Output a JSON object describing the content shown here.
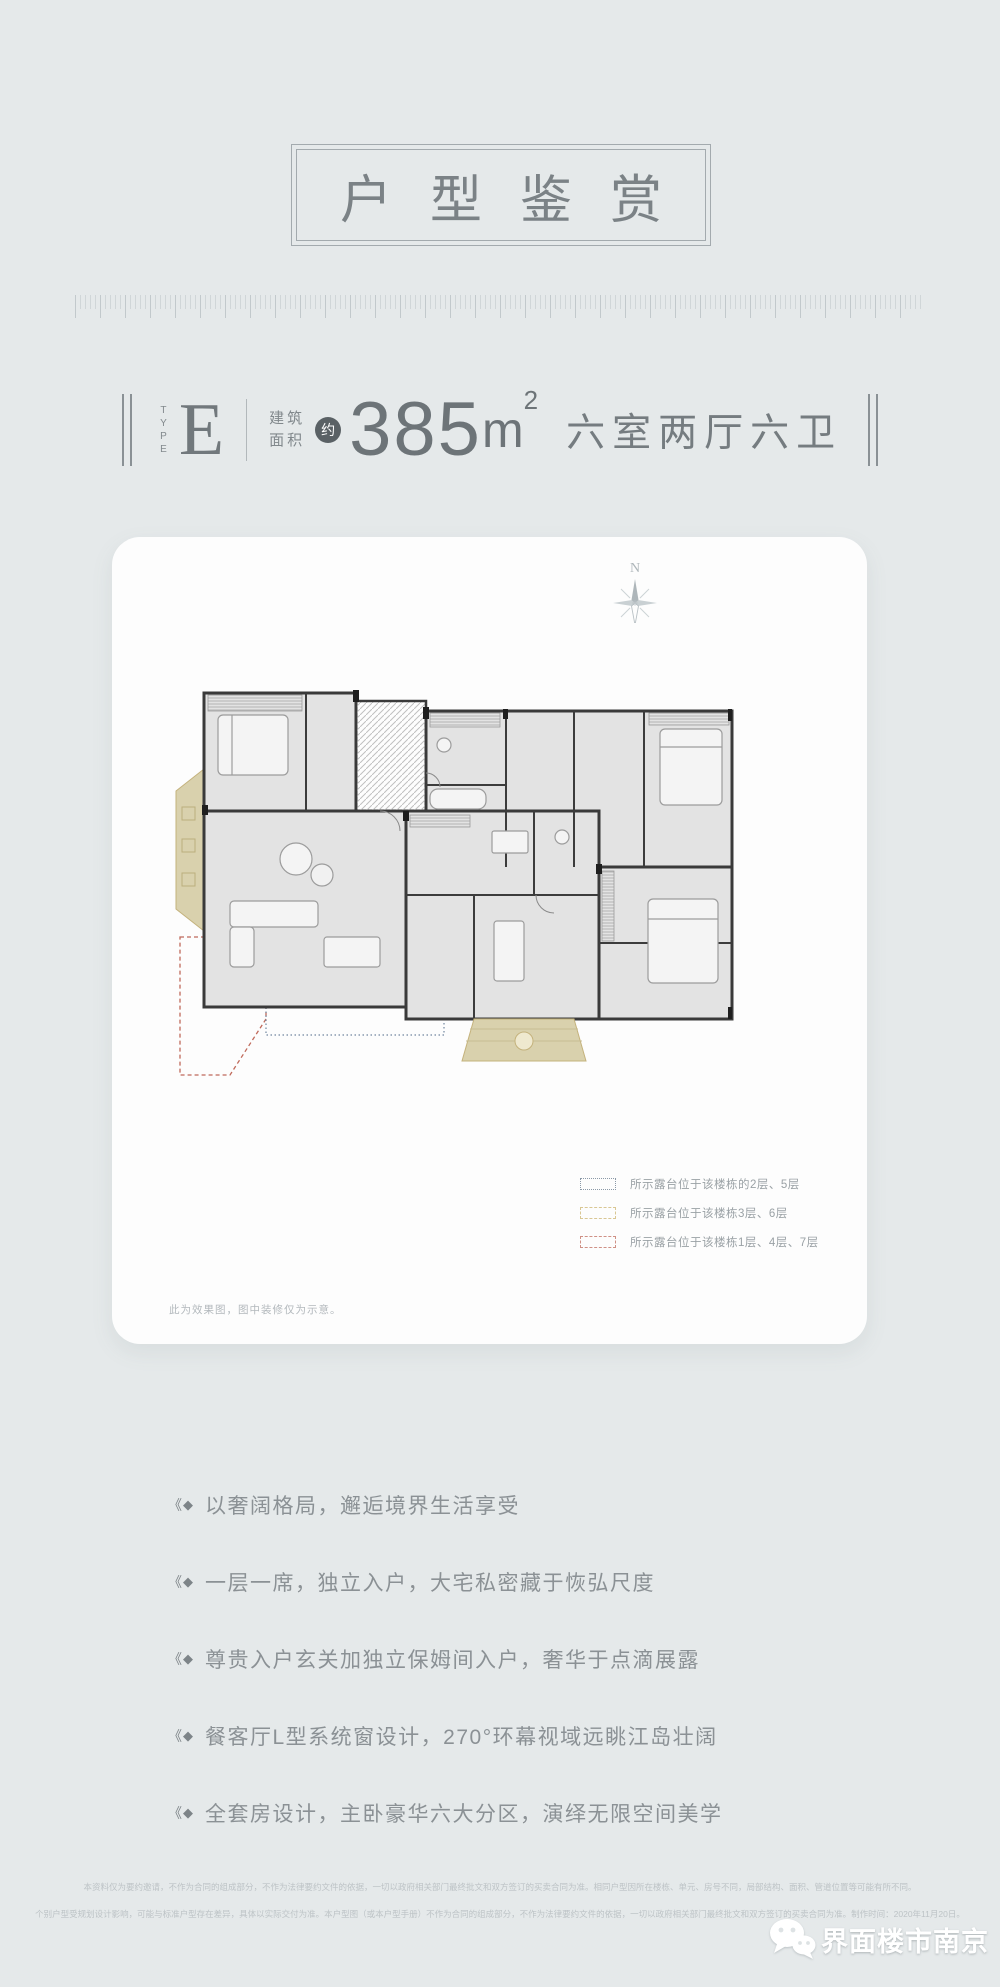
{
  "poster": {
    "title": "户型鉴赏",
    "type_block": {
      "type_word": "TYPE",
      "type_letter": "E",
      "area_label_line1": "建筑",
      "area_label_line2": "面积",
      "approx": "约",
      "area_value": "385",
      "area_unit": "m",
      "area_unit_exp": "2",
      "rooms_text": "六室两厅六卫"
    },
    "card": {
      "compass_n": "N",
      "legend": [
        {
          "label": "所示露台位于该楼栋的2层、5层",
          "swatch_border": "#8b99a7",
          "swatch_style": "dotted"
        },
        {
          "label": "所示露台位于该楼栋3层、6层",
          "swatch_border": "#d9c794",
          "swatch_style": "dashed"
        },
        {
          "label": "所示露台位于该楼栋1层、4层、7层",
          "swatch_border": "#cf9186",
          "swatch_style": "dashed"
        }
      ],
      "note": "此为效果图，图中装修仅为示意。"
    },
    "feature_icon_chevron": "《",
    "feature_icon_diamond": "◆",
    "features": [
      {
        "text": "以奢阔格局，邂逅境界生活享受"
      },
      {
        "text": "一层一席，独立入户，大宅私密藏于恢弘尺度"
      },
      {
        "text": "尊贵入户玄关加独立保姆间入户，奢华于点滴展露"
      },
      {
        "text": "餐客厅L型系统窗设计，270°环幕视域远眺江岛壮阔"
      },
      {
        "text": "全套房设计，主卧豪华六大分区，演绎无限空间美学"
      }
    ],
    "disclaimer_line1": "本资料仅为要约邀请，不作为合同的组成部分，不作为法律要约文件的依据，一切以政府相关部门最终批文和双方签订的买卖合同为准。相同户型因所在楼栋、单元、房号不同，局部结构、面积、管道位置等可能有所不同。",
    "disclaimer_line2": "个别户型受规划设计影响，可能与标准户型存在差异，具体以实际交付为准。本户型图（或本户型手册）不作为合同的组成部分，不作为法律要约文件的依据，一切以政府相关部门最终批文和双方签订的买卖合同为准。制作时间：2020年11月20日。",
    "watermark": "界面楼市南京",
    "colors": {
      "background": "#e5e9ea",
      "card": "#fdfdfd",
      "heading_text": "#7b8286",
      "body_text": "#8b9195",
      "muted_text": "#bdc3c6",
      "legend_blue": "#8b99a7",
      "legend_tan": "#d9c794",
      "legend_red": "#cf9186",
      "terrace_tan": "#d9d1ad",
      "terrace_red_outline": "#c06a5b",
      "terrace_blue_outline": "#71869f",
      "approx_badge_bg": "#5a6165"
    }
  }
}
